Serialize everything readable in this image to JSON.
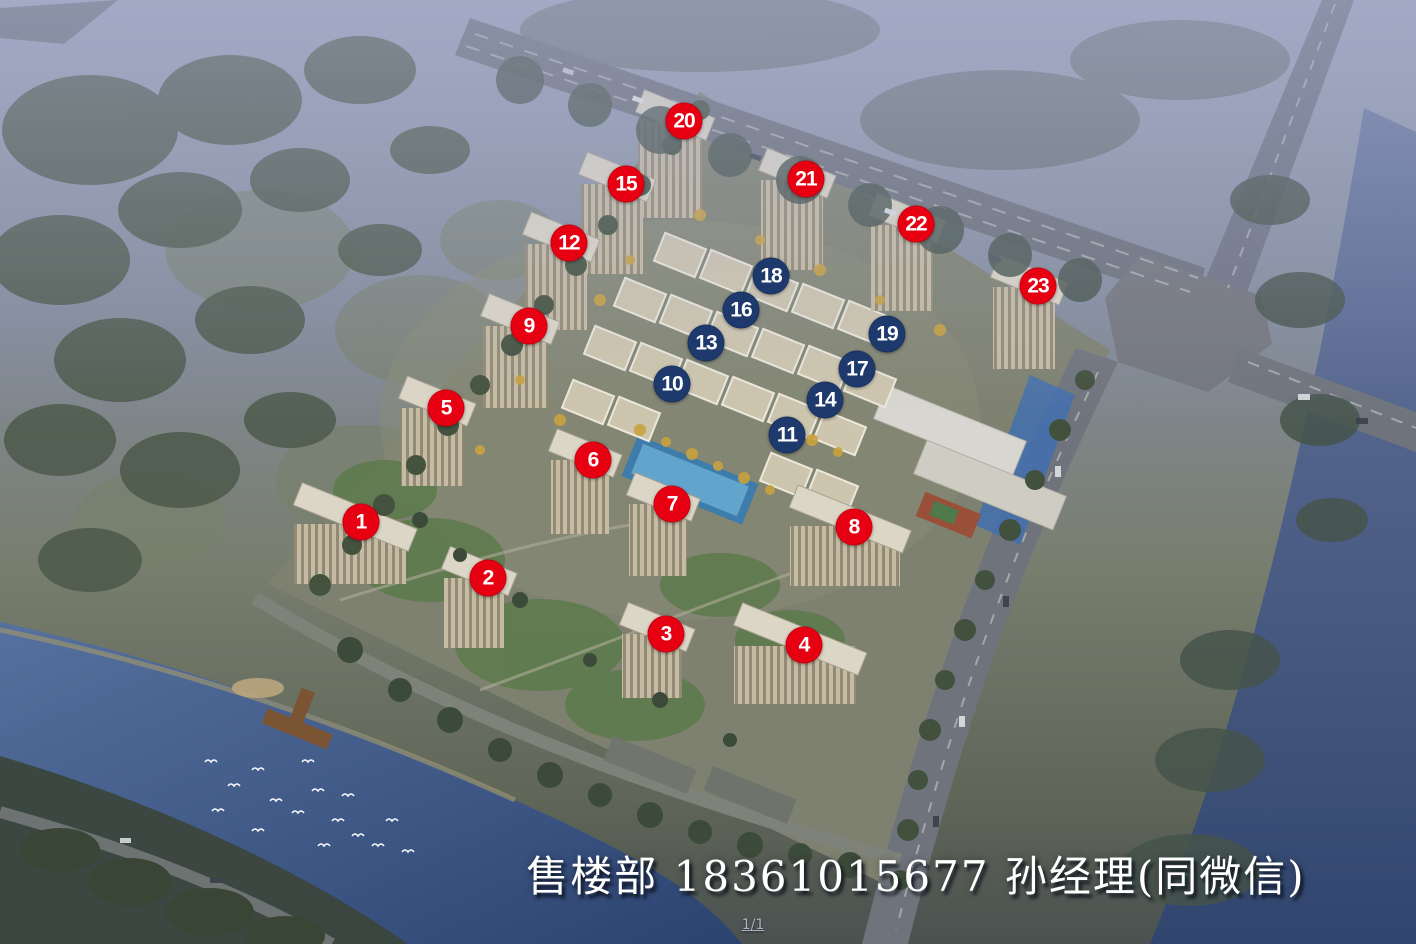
{
  "overlay": {
    "caption": "售楼部 18361015677 孙经理(同微信)",
    "page_indicator": "1/1"
  },
  "markers": {
    "colors": {
      "highrise": "#e60012",
      "midrise": "#1e3a6d",
      "text": "#ffffff"
    },
    "items": [
      {
        "label": "1",
        "type": "highrise",
        "x_pct": 25.49,
        "y_pct": 55.3
      },
      {
        "label": "2",
        "type": "highrise",
        "x_pct": 34.46,
        "y_pct": 61.23
      },
      {
        "label": "3",
        "type": "highrise",
        "x_pct": 47.03,
        "y_pct": 67.16
      },
      {
        "label": "4",
        "type": "highrise",
        "x_pct": 56.78,
        "y_pct": 68.33
      },
      {
        "label": "5",
        "type": "highrise",
        "x_pct": 31.5,
        "y_pct": 43.22
      },
      {
        "label": "6",
        "type": "highrise",
        "x_pct": 41.88,
        "y_pct": 48.73
      },
      {
        "label": "7",
        "type": "highrise",
        "x_pct": 47.46,
        "y_pct": 53.39
      },
      {
        "label": "8",
        "type": "highrise",
        "x_pct": 60.31,
        "y_pct": 55.83
      },
      {
        "label": "9",
        "type": "highrise",
        "x_pct": 37.36,
        "y_pct": 34.53
      },
      {
        "label": "10",
        "type": "midrise",
        "x_pct": 47.46,
        "y_pct": 40.68
      },
      {
        "label": "11",
        "type": "midrise",
        "x_pct": 55.58,
        "y_pct": 46.08
      },
      {
        "label": "12",
        "type": "highrise",
        "x_pct": 40.18,
        "y_pct": 25.74
      },
      {
        "label": "13",
        "type": "midrise",
        "x_pct": 49.86,
        "y_pct": 36.33
      },
      {
        "label": "14",
        "type": "midrise",
        "x_pct": 58.26,
        "y_pct": 42.37
      },
      {
        "label": "15",
        "type": "highrise",
        "x_pct": 44.21,
        "y_pct": 19.49
      },
      {
        "label": "16",
        "type": "midrise",
        "x_pct": 52.33,
        "y_pct": 32.84
      },
      {
        "label": "17",
        "type": "midrise",
        "x_pct": 60.52,
        "y_pct": 39.09
      },
      {
        "label": "18",
        "type": "midrise",
        "x_pct": 54.45,
        "y_pct": 29.24
      },
      {
        "label": "19",
        "type": "midrise",
        "x_pct": 62.64,
        "y_pct": 35.38
      },
      {
        "label": "20",
        "type": "highrise",
        "x_pct": 48.31,
        "y_pct": 12.82
      },
      {
        "label": "21",
        "type": "highrise",
        "x_pct": 56.92,
        "y_pct": 18.96
      },
      {
        "label": "22",
        "type": "highrise",
        "x_pct": 64.69,
        "y_pct": 23.73
      },
      {
        "label": "23",
        "type": "highrise",
        "x_pct": 73.31,
        "y_pct": 30.3
      }
    ]
  }
}
